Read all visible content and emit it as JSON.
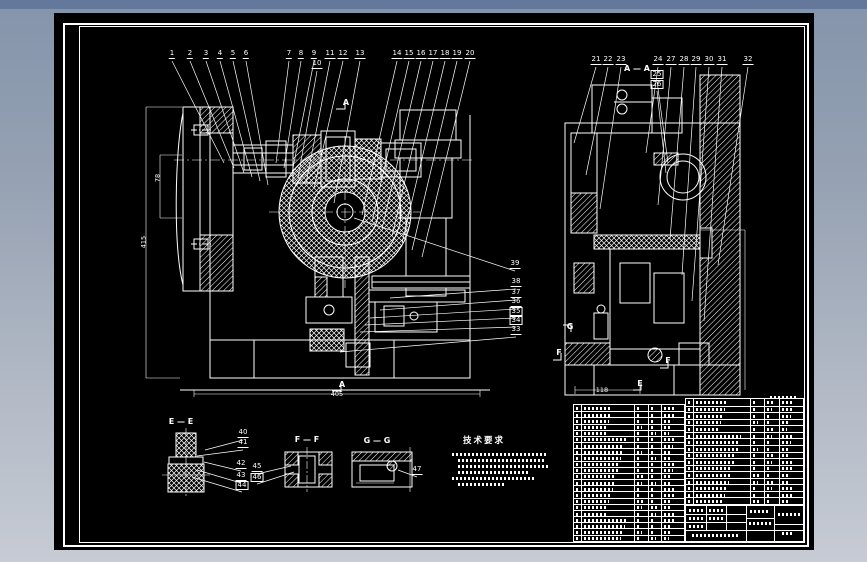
{
  "window": {
    "background_top": "#64789b",
    "background_bottom": "#c6cbd4",
    "canvas_color": "#000000",
    "line_color": "#ffffff"
  },
  "drawing": {
    "type": "mechanical fixture assembly drawing, white line art on black",
    "callouts": [
      {
        "n": "1",
        "x": 118,
        "y": 46,
        "tx": 170,
        "ty": 150
      },
      {
        "n": "2",
        "x": 136,
        "y": 46,
        "tx": 180,
        "ty": 155
      },
      {
        "n": "3",
        "x": 152,
        "y": 46,
        "tx": 190,
        "ty": 160
      },
      {
        "n": "4",
        "x": 166,
        "y": 46,
        "tx": 198,
        "ty": 164
      },
      {
        "n": "5",
        "x": 179,
        "y": 46,
        "tx": 206,
        "ty": 168
      },
      {
        "n": "6",
        "x": 192,
        "y": 46,
        "tx": 214,
        "ty": 172
      },
      {
        "n": "7",
        "x": 235,
        "y": 46,
        "tx": 222,
        "ty": 150
      },
      {
        "n": "8",
        "x": 247,
        "y": 46,
        "tx": 230,
        "ty": 155
      },
      {
        "n": "9",
        "x": 260,
        "y": 46,
        "tx": 238,
        "ty": 160
      },
      {
        "n": "10",
        "x": 263,
        "y": 56,
        "tx": 244,
        "ty": 165
      },
      {
        "n": "11",
        "x": 276,
        "y": 46,
        "tx": 252,
        "ty": 170
      },
      {
        "n": "12",
        "x": 289,
        "y": 46,
        "tx": 260,
        "ty": 175
      },
      {
        "n": "13",
        "x": 306,
        "y": 46,
        "tx": 280,
        "ty": 190
      },
      {
        "n": "14",
        "x": 343,
        "y": 46,
        "tx": 308,
        "ty": 202
      },
      {
        "n": "15",
        "x": 355,
        "y": 46,
        "tx": 318,
        "ty": 209
      },
      {
        "n": "16",
        "x": 367,
        "y": 46,
        "tx": 328,
        "ty": 216
      },
      {
        "n": "17",
        "x": 379,
        "y": 46,
        "tx": 338,
        "ty": 223
      },
      {
        "n": "18",
        "x": 391,
        "y": 46,
        "tx": 348,
        "ty": 230
      },
      {
        "n": "19",
        "x": 403,
        "y": 46,
        "tx": 358,
        "ty": 237
      },
      {
        "n": "20",
        "x": 416,
        "y": 46,
        "tx": 368,
        "ty": 244
      },
      {
        "n": "21",
        "x": 542,
        "y": 52,
        "tx": 520,
        "ty": 130
      },
      {
        "n": "22",
        "x": 554,
        "y": 52,
        "tx": 532,
        "ty": 162
      },
      {
        "n": "23",
        "x": 567,
        "y": 52,
        "tx": 546,
        "ty": 196
      },
      {
        "n": "24",
        "x": 604,
        "y": 52,
        "tx": 592,
        "ty": 140
      },
      {
        "n": "25",
        "x": 603,
        "y": 66,
        "tx": 614,
        "ty": 150,
        "boxed": true
      },
      {
        "n": "26",
        "x": 603,
        "y": 76,
        "tx": 612,
        "ty": 160,
        "boxed": true
      },
      {
        "n": "27",
        "x": 617,
        "y": 52,
        "tx": 604,
        "ty": 192
      },
      {
        "n": "28",
        "x": 630,
        "y": 52,
        "tx": 616,
        "ty": 226
      },
      {
        "n": "29",
        "x": 642,
        "y": 52,
        "tx": 628,
        "ty": 262
      },
      {
        "n": "30",
        "x": 655,
        "y": 52,
        "tx": 638,
        "ty": 288
      },
      {
        "n": "31",
        "x": 668,
        "y": 52,
        "tx": 650,
        "ty": 308
      },
      {
        "n": "32",
        "x": 694,
        "y": 52,
        "tx": 664,
        "ty": 252
      },
      {
        "n": "33",
        "x": 462,
        "y": 322,
        "tx": 286,
        "ty": 339
      },
      {
        "n": "34",
        "x": 462,
        "y": 312,
        "tx": 306,
        "ty": 319,
        "boxed": true
      },
      {
        "n": "35",
        "x": 462,
        "y": 303,
        "tx": 311,
        "ty": 312,
        "boxed": true
      },
      {
        "n": "36",
        "x": 462,
        "y": 294,
        "tx": 316,
        "ty": 305
      },
      {
        "n": "37",
        "x": 462,
        "y": 285,
        "tx": 326,
        "ty": 297
      },
      {
        "n": "38",
        "x": 462,
        "y": 274,
        "tx": 336,
        "ty": 285
      },
      {
        "n": "39",
        "x": 461,
        "y": 256,
        "tx": 300,
        "ty": 205
      },
      {
        "n": "40",
        "x": 189,
        "y": 425,
        "tx": 151,
        "ty": 437
      },
      {
        "n": "41",
        "x": 189,
        "y": 435,
        "tx": 143,
        "ty": 443
      },
      {
        "n": "42",
        "x": 187,
        "y": 456,
        "tx": 150,
        "ty": 449
      },
      {
        "n": "43",
        "x": 187,
        "y": 468,
        "tx": 143,
        "ty": 457
      },
      {
        "n": "44",
        "x": 188,
        "y": 477,
        "tx": 138,
        "ty": 464,
        "boxed": true
      },
      {
        "n": "45",
        "x": 203,
        "y": 459,
        "tx": 237,
        "ty": 453
      },
      {
        "n": "46",
        "x": 203,
        "y": 469,
        "tx": 240,
        "ty": 459,
        "boxed": true
      },
      {
        "n": "47",
        "x": 363,
        "y": 462,
        "tx": 344,
        "ty": 457
      }
    ],
    "section_labels": [
      {
        "text": "A",
        "x": 292,
        "y": 93
      },
      {
        "text": "A",
        "x": 288,
        "y": 375
      },
      {
        "text": "A — A",
        "x": 583,
        "y": 59
      },
      {
        "text": "E — E",
        "x": 127,
        "y": 412
      },
      {
        "text": "F — F",
        "x": 253,
        "y": 430
      },
      {
        "text": "G — G",
        "x": 323,
        "y": 431
      },
      {
        "text": "G",
        "x": 516,
        "y": 317
      },
      {
        "text": "F",
        "x": 505,
        "y": 343
      },
      {
        "text": "F",
        "x": 614,
        "y": 351
      },
      {
        "text": "E",
        "x": 586,
        "y": 374
      }
    ],
    "dimensions": [
      {
        "text": "405",
        "x": 283,
        "y": 385
      },
      {
        "text": "118",
        "x": 548,
        "y": 381
      },
      {
        "text": "78",
        "x": 104,
        "y": 165,
        "rot": true
      },
      {
        "text": "415",
        "x": 90,
        "y": 229,
        "rot": true
      }
    ],
    "tech_requirements": {
      "title": "技术要求",
      "x": 430,
      "y": 432,
      "illegible_lines": [
        {
          "x": 398,
          "y": 440,
          "w": 96
        },
        {
          "x": 404,
          "y": 446,
          "w": 88
        },
        {
          "x": 404,
          "y": 452,
          "w": 92
        },
        {
          "x": 404,
          "y": 458,
          "w": 70
        },
        {
          "x": 398,
          "y": 464,
          "w": 84
        },
        {
          "x": 404,
          "y": 470,
          "w": 46
        }
      ]
    }
  },
  "bom": {
    "note": "parts list text is below legibility at this resolution; rendered as smudge rows",
    "left_table": {
      "x": 519,
      "y": 391,
      "w": 112,
      "h": 138,
      "rows": 22,
      "col_widths": [
        8,
        54,
        14,
        14,
        22
      ]
    },
    "right_table": {
      "x": 631,
      "y": 385,
      "w": 119,
      "h": 107,
      "rows": 16,
      "col_widths": [
        8,
        58,
        14,
        16,
        23
      ]
    },
    "header_smudge": {
      "x": 716,
      "y": 383,
      "w": 26
    }
  }
}
